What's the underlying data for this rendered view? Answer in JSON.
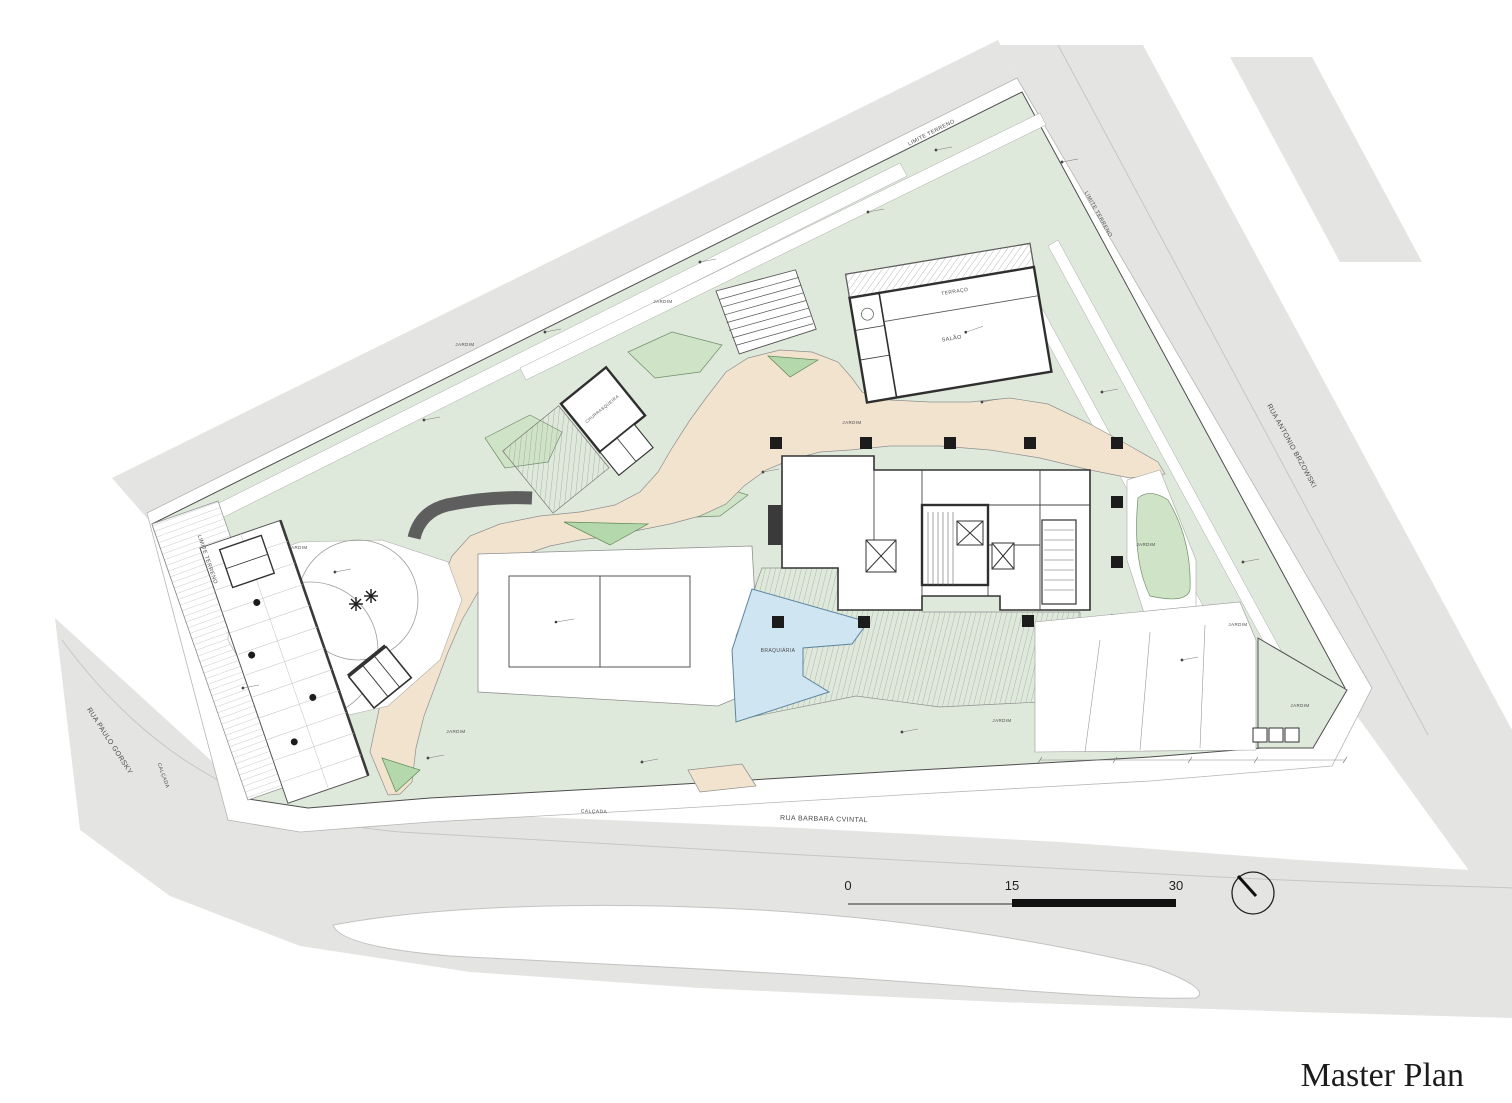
{
  "document": {
    "title": "Master Plan"
  },
  "scale_bar": {
    "tick_start": "0",
    "tick_mid": "15",
    "tick_end": "30"
  },
  "colors": {
    "street": "#e4e5e2",
    "sidewalk": "#ffffff",
    "site_green": "#dfe9db",
    "leaf_green": "#cfe3c6",
    "island_green": "#b4d8ab",
    "path_beige": "#f2e3ce",
    "pool_blue": "#cfe5f2",
    "title": "#1c1c1c"
  },
  "plan_labels": [
    {
      "t": "RUA PAULO GORSKY",
      "x": 108,
      "y": 742,
      "r": 57,
      "s": 7
    },
    {
      "t": "CALÇADA",
      "x": 162,
      "y": 776,
      "r": 70,
      "s": 5
    },
    {
      "t": "RUA BARBARA CVINTAL",
      "x": 824,
      "y": 821,
      "r": 1.5,
      "s": 7
    },
    {
      "t": "CALÇADA",
      "x": 594,
      "y": 813,
      "r": 1.5,
      "s": 5
    },
    {
      "t": "RUA ANTONIO BRZOWSKI",
      "x": 1290,
      "y": 447,
      "r": 61,
      "s": 7
    },
    {
      "t": "LIMITE TERRENO",
      "x": 932,
      "y": 134,
      "r": -27,
      "s": 5.5
    },
    {
      "t": "LIMITE TERRENO",
      "x": 1097,
      "y": 215,
      "r": 61,
      "s": 5.5
    },
    {
      "t": "LIMITE TERRENO",
      "x": 206,
      "y": 560,
      "r": 71,
      "s": 5.5
    },
    {
      "t": "JARDIM",
      "x": 465,
      "y": 346,
      "r": 0,
      "s": 4.5
    },
    {
      "t": "JARDIM",
      "x": 663,
      "y": 303,
      "r": 0,
      "s": 4.5
    },
    {
      "t": "JARDIM",
      "x": 852,
      "y": 424,
      "r": 0,
      "s": 4.5
    },
    {
      "t": "JARDIM",
      "x": 298,
      "y": 549,
      "r": 0,
      "s": 4.5
    },
    {
      "t": "JARDIM",
      "x": 1146,
      "y": 546,
      "r": 0,
      "s": 4.5
    },
    {
      "t": "JARDIM",
      "x": 1238,
      "y": 626,
      "r": 0,
      "s": 4.5
    },
    {
      "t": "JARDIM",
      "x": 1300,
      "y": 707,
      "r": 0,
      "s": 4.5
    },
    {
      "t": "JARDIM",
      "x": 456,
      "y": 733,
      "r": 0,
      "s": 4.5
    },
    {
      "t": "JARDIM",
      "x": 1002,
      "y": 722,
      "r": 0,
      "s": 4.5
    },
    {
      "t": "TERRAÇO",
      "x": 955,
      "y": 293,
      "r": -9.5,
      "s": 5
    },
    {
      "t": "SALÃO",
      "x": 952,
      "y": 340,
      "r": -9.5,
      "s": 5.5
    },
    {
      "t": "CHURRASQUEIRA",
      "x": 603,
      "y": 410,
      "r": -39,
      "s": 4.2
    },
    {
      "t": "BRAQUIÁRIA",
      "x": 778,
      "y": 652,
      "r": 0,
      "s": 5
    }
  ]
}
